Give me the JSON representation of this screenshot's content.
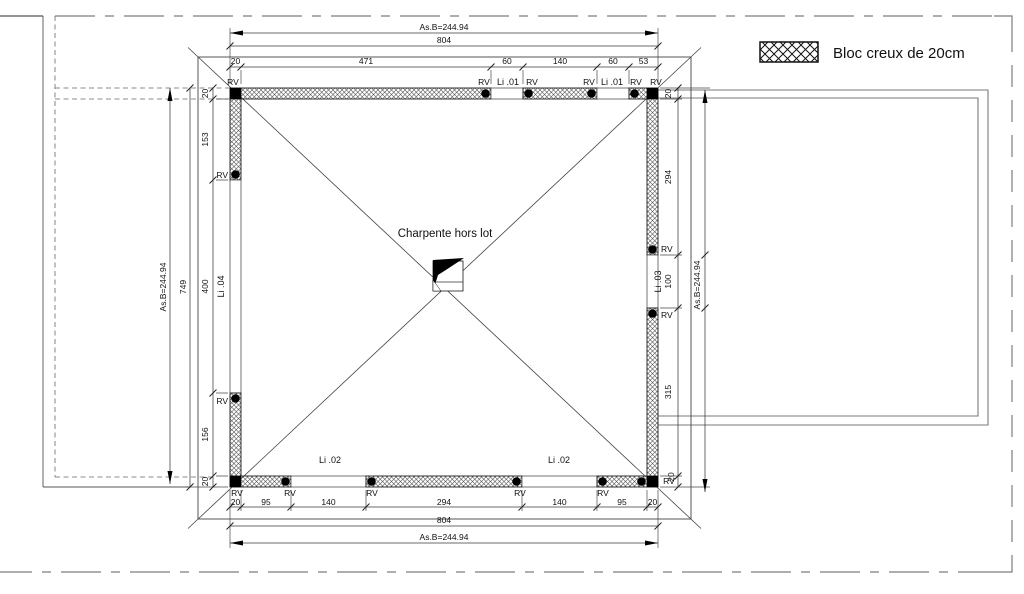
{
  "legend": {
    "label": "Bloc  creux de 20cm"
  },
  "center_note": "Charpente hors lot",
  "labels": {
    "rv": "RV",
    "li01": "Li .01",
    "li02": "Li .02",
    "li03": "Li .03",
    "li04": "Li .04"
  },
  "dims": {
    "top": {
      "asb": "As.B=244.94",
      "total": "804",
      "segments": [
        "20",
        "471",
        "60",
        "140",
        "60",
        "53"
      ]
    },
    "bottom": {
      "asb": "As.B=244.94",
      "total": "804",
      "segments": [
        "20",
        "95",
        "140",
        "294",
        "140",
        "95",
        "20"
      ]
    },
    "left": {
      "asb": "As.B=244.94",
      "total": "749",
      "segments": [
        "20",
        "153",
        "400",
        "156",
        "20"
      ]
    },
    "right": {
      "asb": "As.B=244.94",
      "segments": [
        "20",
        "294",
        "100",
        "315",
        "20"
      ]
    }
  },
  "colors": {
    "line": "#2a2a2a",
    "dim_line": "#3a3a3a",
    "muted_gray": "#7a7a7a",
    "hatch": "#4a4a4a",
    "post": "#000000",
    "background": "#ffffff"
  }
}
